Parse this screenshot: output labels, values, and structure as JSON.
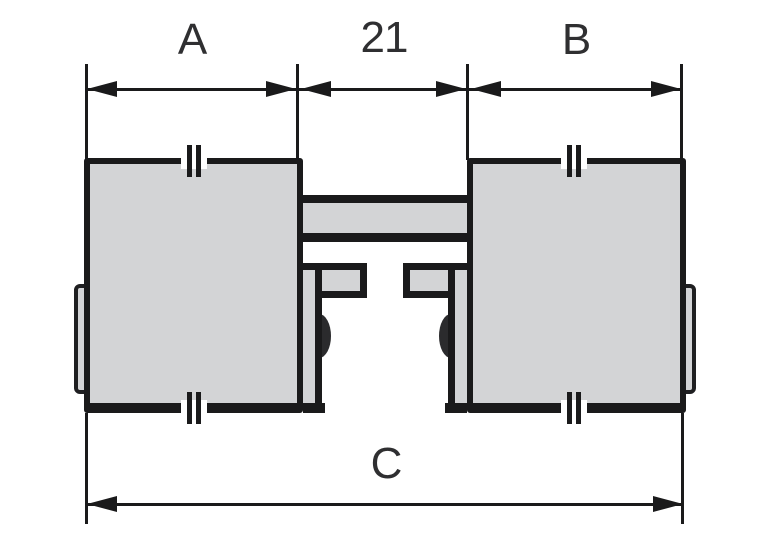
{
  "diagram": {
    "type": "technical-dimension-drawing",
    "description": "Front view of a twin housing unit (two grey blocks joined by a centre bracket with mounting flanges and rollers) annotated with dimension lines",
    "dimensions": {
      "top": [
        {
          "label": "A"
        },
        {
          "label": "21"
        },
        {
          "label": "B"
        }
      ],
      "bottom": [
        {
          "label": "C"
        }
      ]
    },
    "colors": {
      "housing_fill": "#d3d4d6",
      "outline": "#1a1a1b",
      "roller": "#2b2b2d",
      "label_text": "#2f2f31",
      "background": "#ffffff"
    }
  }
}
